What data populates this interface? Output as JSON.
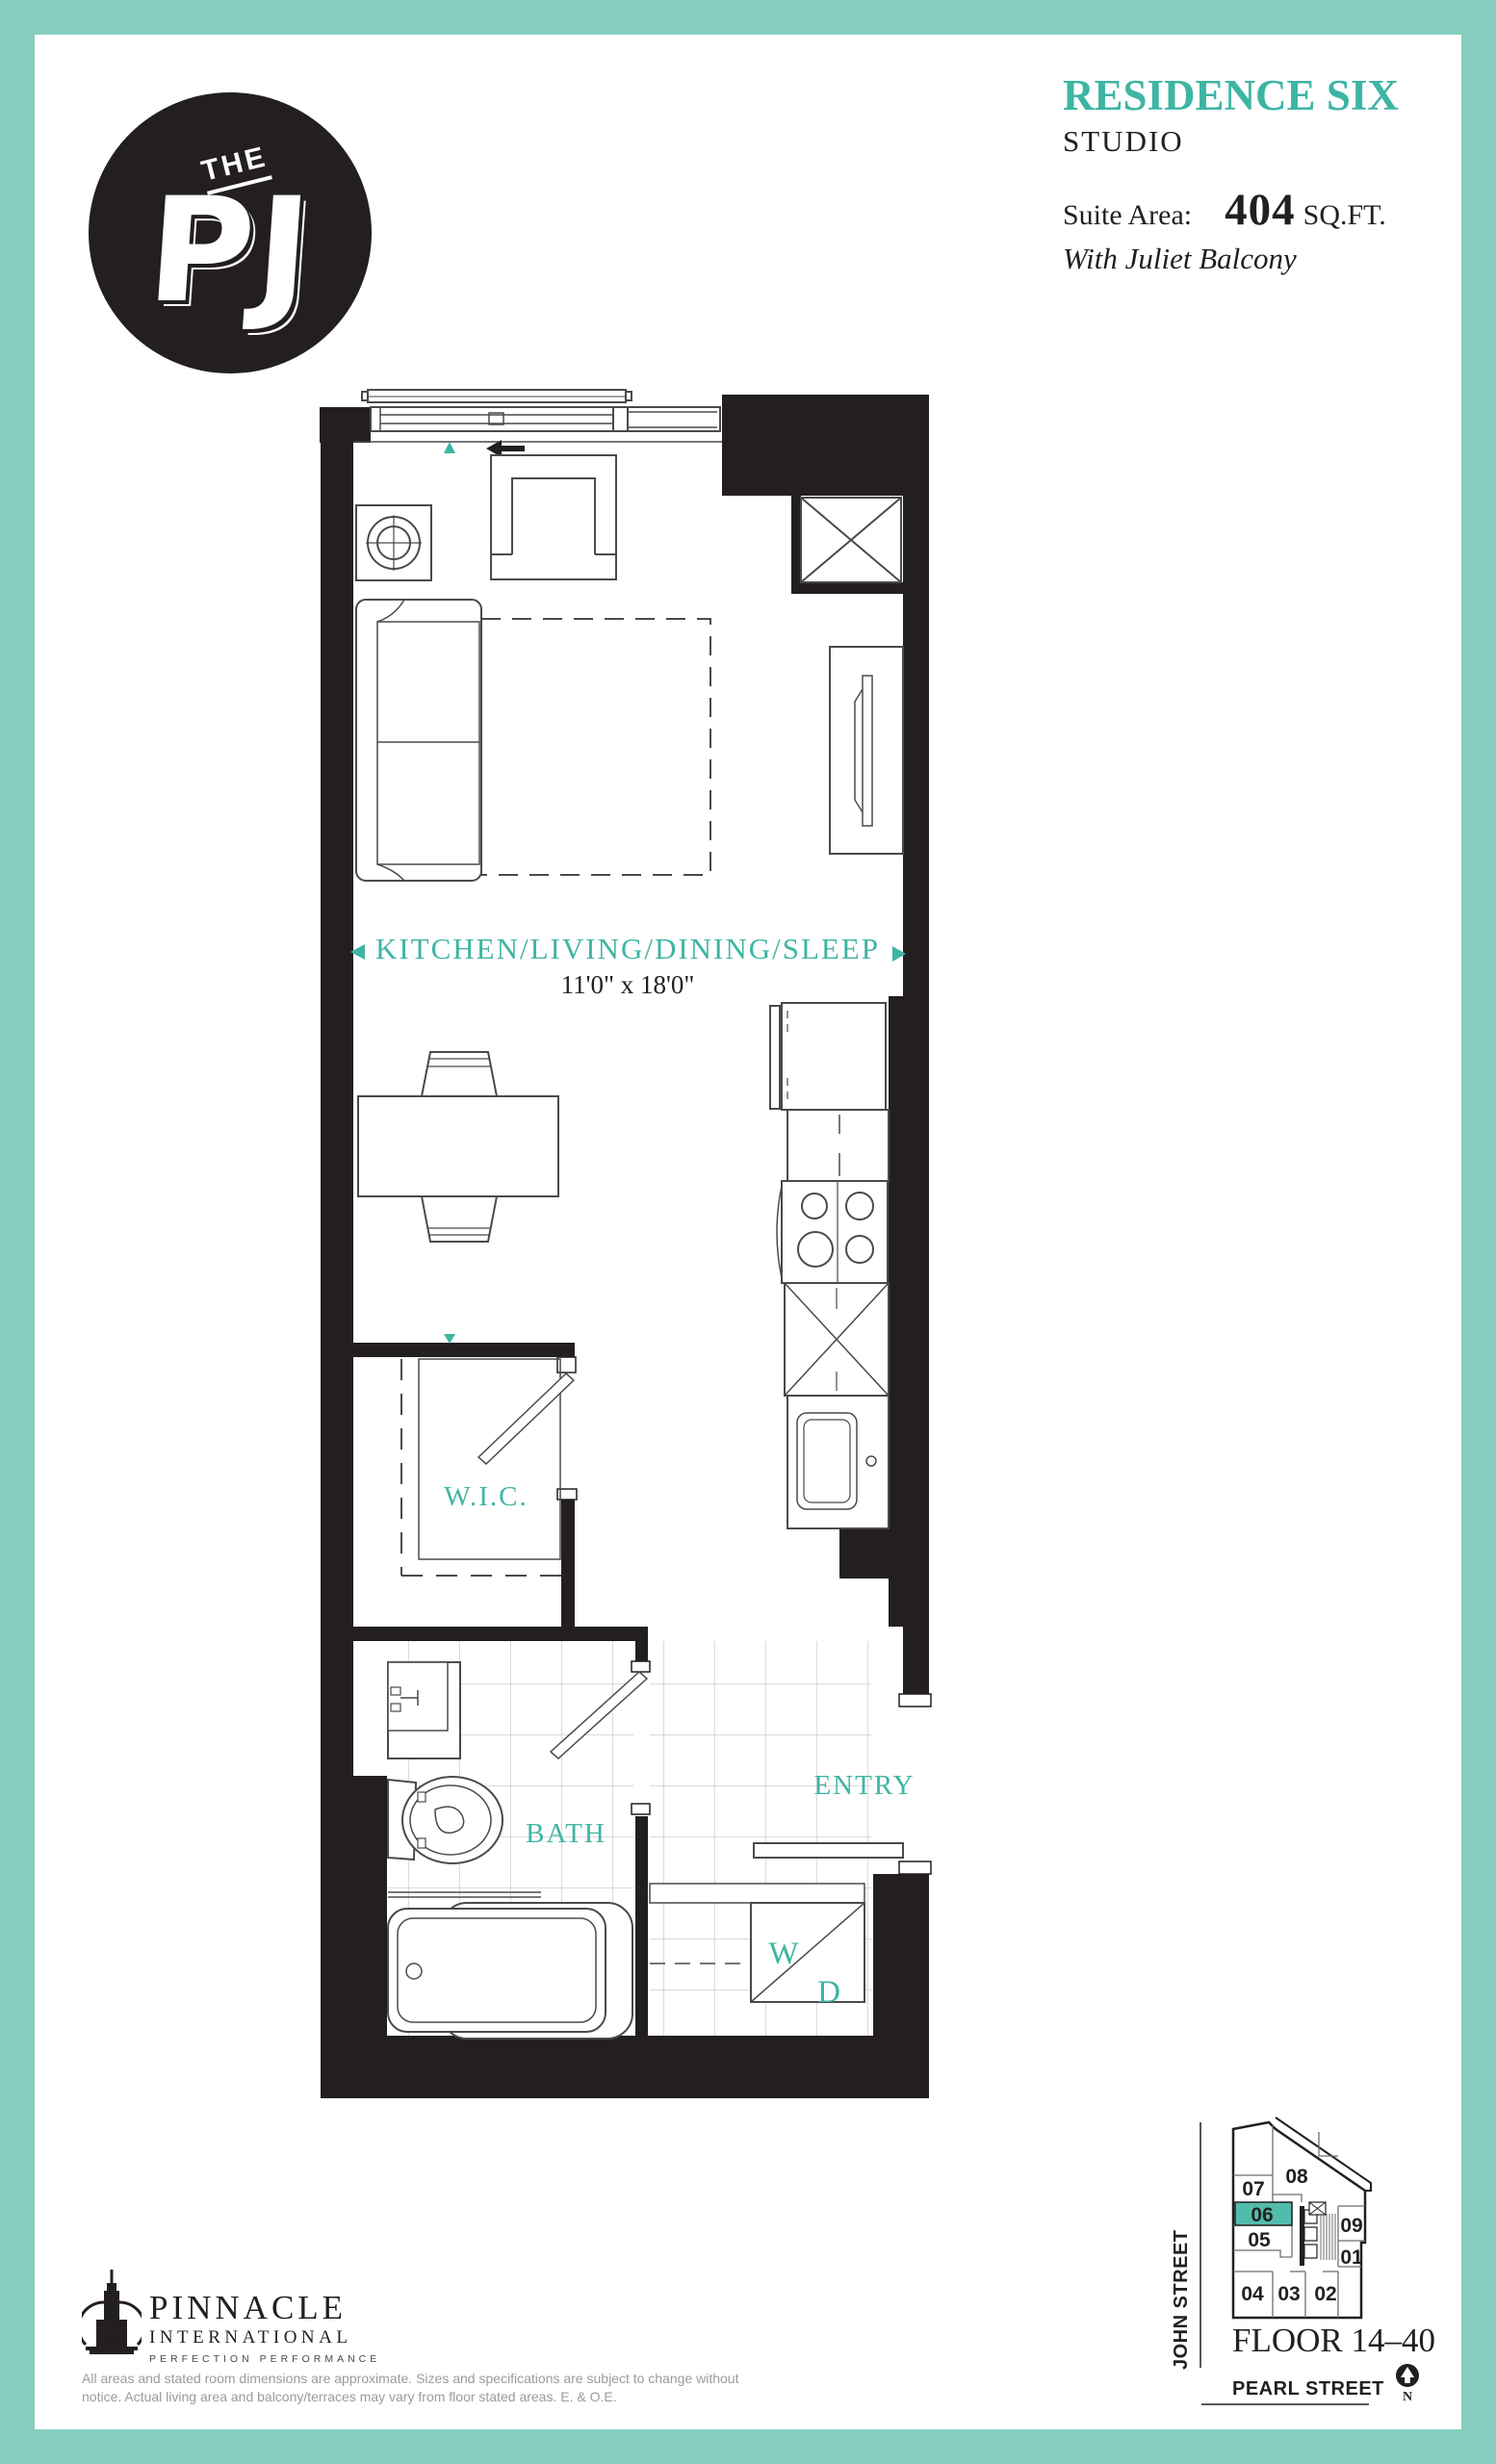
{
  "logo": {
    "the": "THE",
    "pj": "PJ"
  },
  "header": {
    "residence": "RESIDENCE SIX",
    "suite_type": "STUDIO",
    "suite_area_label": "Suite Area:",
    "suite_area_value": "404",
    "suite_area_unit": "SQ.FT.",
    "subtitle": "With Juliet Balcony"
  },
  "plan": {
    "main_label": "KITCHEN/LIVING/DINING/SLEEP",
    "main_dims": "11'0\" x 18'0\"",
    "wic": "W.I.C.",
    "bath": "BATH",
    "entry": "ENTRY",
    "washer": "W",
    "dryer": "D"
  },
  "keyplan": {
    "units": [
      {
        "label": "07"
      },
      {
        "label": "08"
      },
      {
        "label": "06",
        "highlighted": true
      },
      {
        "label": "05"
      },
      {
        "label": "09"
      },
      {
        "label": "01"
      },
      {
        "label": "04"
      },
      {
        "label": "03"
      },
      {
        "label": "02"
      }
    ],
    "highlight_color": "#52bcac",
    "floor": "FLOOR 14–40",
    "street_left": "JOHN STREET",
    "street_bottom": "PEARL STREET",
    "north": "N"
  },
  "footer": {
    "brand1": "PINNACLE",
    "brand2": "INTERNATIONAL",
    "brand3": "PERFECTION  PERFORMANCE",
    "disclaimer_line1": "All areas and stated room dimensions are approximate. Sizes and specifications are subject to change without",
    "disclaimer_line2": "notice. Actual living area and balcony/terraces may vary from floor stated areas. E. & O.E."
  },
  "colors": {
    "border_teal": "#85cdbe",
    "accent_teal": "#3eb5a3",
    "wall_black": "#231f20",
    "disclaimer_gray": "#9b9b9d"
  }
}
